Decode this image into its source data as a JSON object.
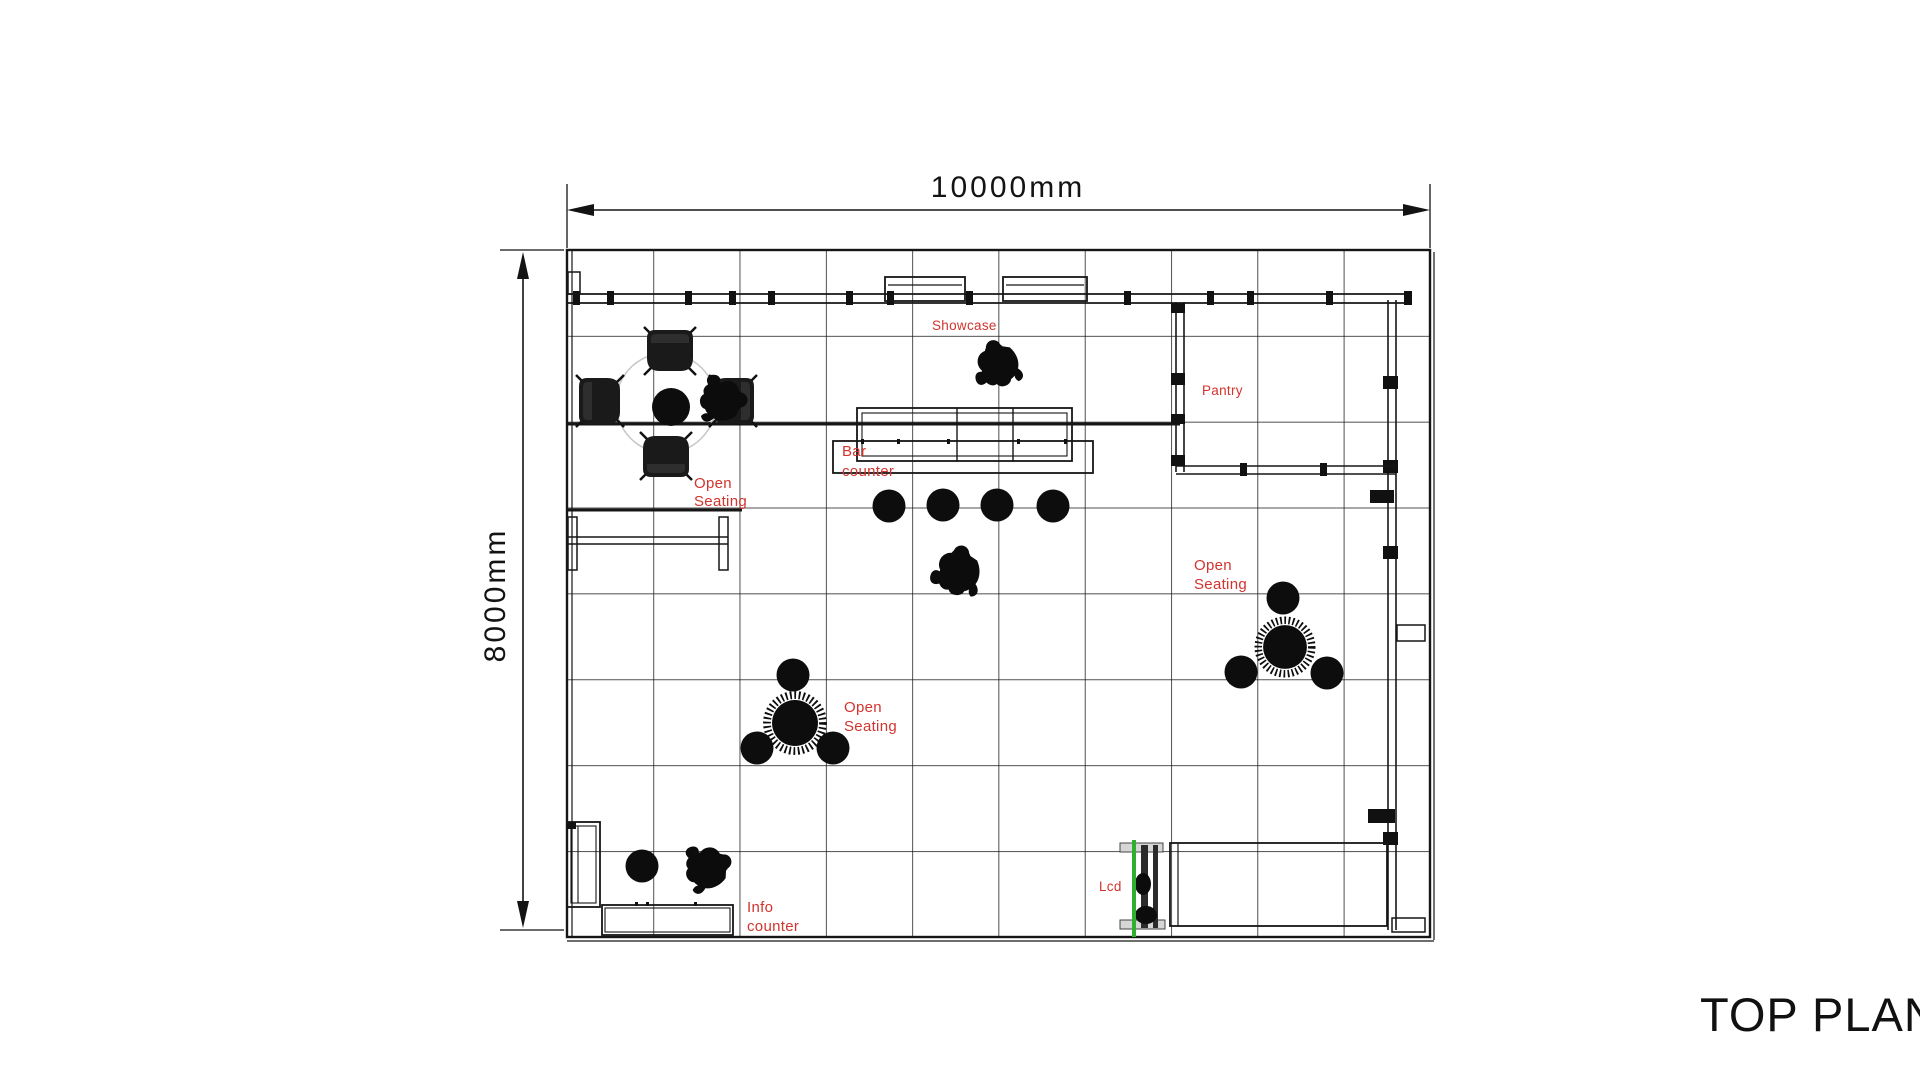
{
  "title": "TOP PLAN",
  "dimensions": {
    "width": "10000mm",
    "height": "8000mm"
  },
  "grid": {
    "columns": 10,
    "rows": 8,
    "cell_mm": 1000
  },
  "labels": {
    "showcase": "Showcase",
    "pantry": "Pantry",
    "lcd": "Lcd",
    "bar_counter": [
      "Bar",
      "counter"
    ],
    "open_seating_left": [
      "Open",
      "Seating"
    ],
    "open_seating_center": [
      "Open",
      "Seating"
    ],
    "open_seating_right": [
      "Open",
      "Seating"
    ],
    "info_counter": [
      "Info",
      "counter"
    ]
  },
  "colors": {
    "label": "#d2342e",
    "ink": "#161616",
    "lcd_line": "#2fae2f"
  }
}
